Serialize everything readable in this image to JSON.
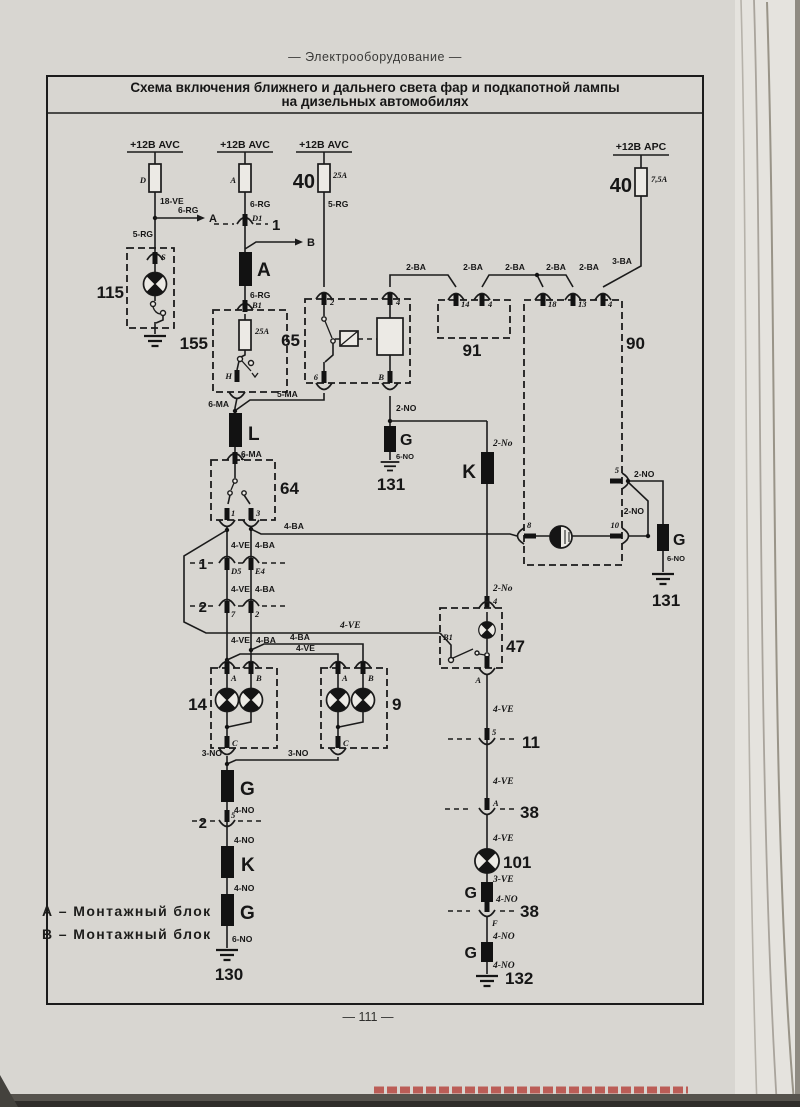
{
  "page": {
    "header": "— Электрооборудование —",
    "title1": "Схема включения ближнего и дальнего света фар и подкапотной лампы",
    "title2": "на дизельных автомобилях",
    "footer": "— 111 —"
  },
  "legend": {
    "a": "А – Монтажный блок",
    "b": "В – Монтажный блок"
  },
  "supply": {
    "s1": "+12В AVC",
    "s2": "+12В AVC",
    "s3": "+12В AVC",
    "s4": "+12В APC"
  },
  "fuse": {
    "d": "D",
    "a": "A",
    "n40a": "40",
    "r25a": "25A",
    "r25b": "25A",
    "n40b": "40",
    "r75": "7,5A"
  },
  "comp": {
    "n115": "115",
    "n155": "155",
    "n65": "65",
    "n64": "64",
    "n91": "91",
    "n90": "90",
    "n47": "47",
    "n14": "14",
    "n9": "9",
    "n101": "101",
    "n11": "11",
    "n38a": "38",
    "n38b": "38",
    "n130": "130",
    "n131a": "131",
    "n131b": "131",
    "n132": "132",
    "row1": "1",
    "row2": "2",
    "conn1": "1",
    "conn2": "2"
  },
  "splice": {
    "a": "A",
    "l": "L",
    "k1": "K",
    "k2": "K",
    "g1": "G",
    "g2": "G",
    "g3": "G",
    "g4": "G",
    "g5": "G",
    "g6": "G"
  },
  "arrow": {
    "a": "A",
    "b": "B"
  },
  "wire": {
    "w18ve": "18-VE",
    "w6rg_a": "6-RG",
    "w5rg1": "5-RG",
    "w6rg1": "6-RG",
    "w6rg2": "6-RG",
    "w5rg2": "5-RG",
    "w3ba": "3-BA",
    "w2ba1": "2-BA",
    "w2ba2": "2-BA",
    "w2ba3": "2-BA",
    "w2ba4": "2-BA",
    "w2ba5": "2-BA",
    "w6ma1": "6-MA",
    "w5ma": "5-MA",
    "w6ma2": "6-MA",
    "w2no1": "2-NO",
    "w6no1": "6-NO",
    "w2no2": "2-No",
    "w2no3": "2-No",
    "w2no4": "2-NO",
    "w2no5": "2-NO",
    "w6no2": "6-NO",
    "w4ba_h": "4-BA",
    "w4ve_long": "4-VE",
    "w4ve_p1": "4-VE",
    "w4ba_p1": "4-BA",
    "w4ve_p2": "4-VE",
    "w4ba_p2": "4-BA",
    "w4ve_p3": "4-VE",
    "w4ba_p3": "4-BA",
    "w4ba_br": "4-BA",
    "w4ve_br": "4-VE",
    "w3no1": "3-NO",
    "w3no2": "3-NO",
    "w4no1": "4-NO",
    "w4no2": "4-NO",
    "w4no3": "4-NO",
    "w6no3": "6-NO",
    "w4ve4": "4-VE",
    "w4ve5": "4-VE",
    "w4ve6": "4-VE",
    "w3ve": "3-VE",
    "w4no4": "4-NO",
    "w4no5": "4-NO",
    "w4no6": "4-NO"
  },
  "term": {
    "s": "S",
    "d1": "D1",
    "b1": "B1",
    "h": "H",
    "t65_2": "2",
    "t65_4": "4",
    "t65_6": "6",
    "t65_b": "B",
    "t64_2": "2",
    "t64_1": "1",
    "t64_3": "3",
    "t91_14": "14",
    "t91_4": "4",
    "t90_18": "18",
    "t90_13": "13",
    "t90_4": "4",
    "t90_8": "8",
    "t90_10": "10",
    "t90_5": "5",
    "d5": "D5",
    "e4": "E4",
    "r2_7": "7",
    "r2_2": "2",
    "a14": "A",
    "b14": "B",
    "c14": "C",
    "a9": "A",
    "b9": "B",
    "c9": "C",
    "t47_4": "4",
    "t47_b1": "B1",
    "t47_a": "A",
    "t11_5": "5",
    "t2_5": "5",
    "t38_a": "A",
    "t38_f": "F"
  }
}
